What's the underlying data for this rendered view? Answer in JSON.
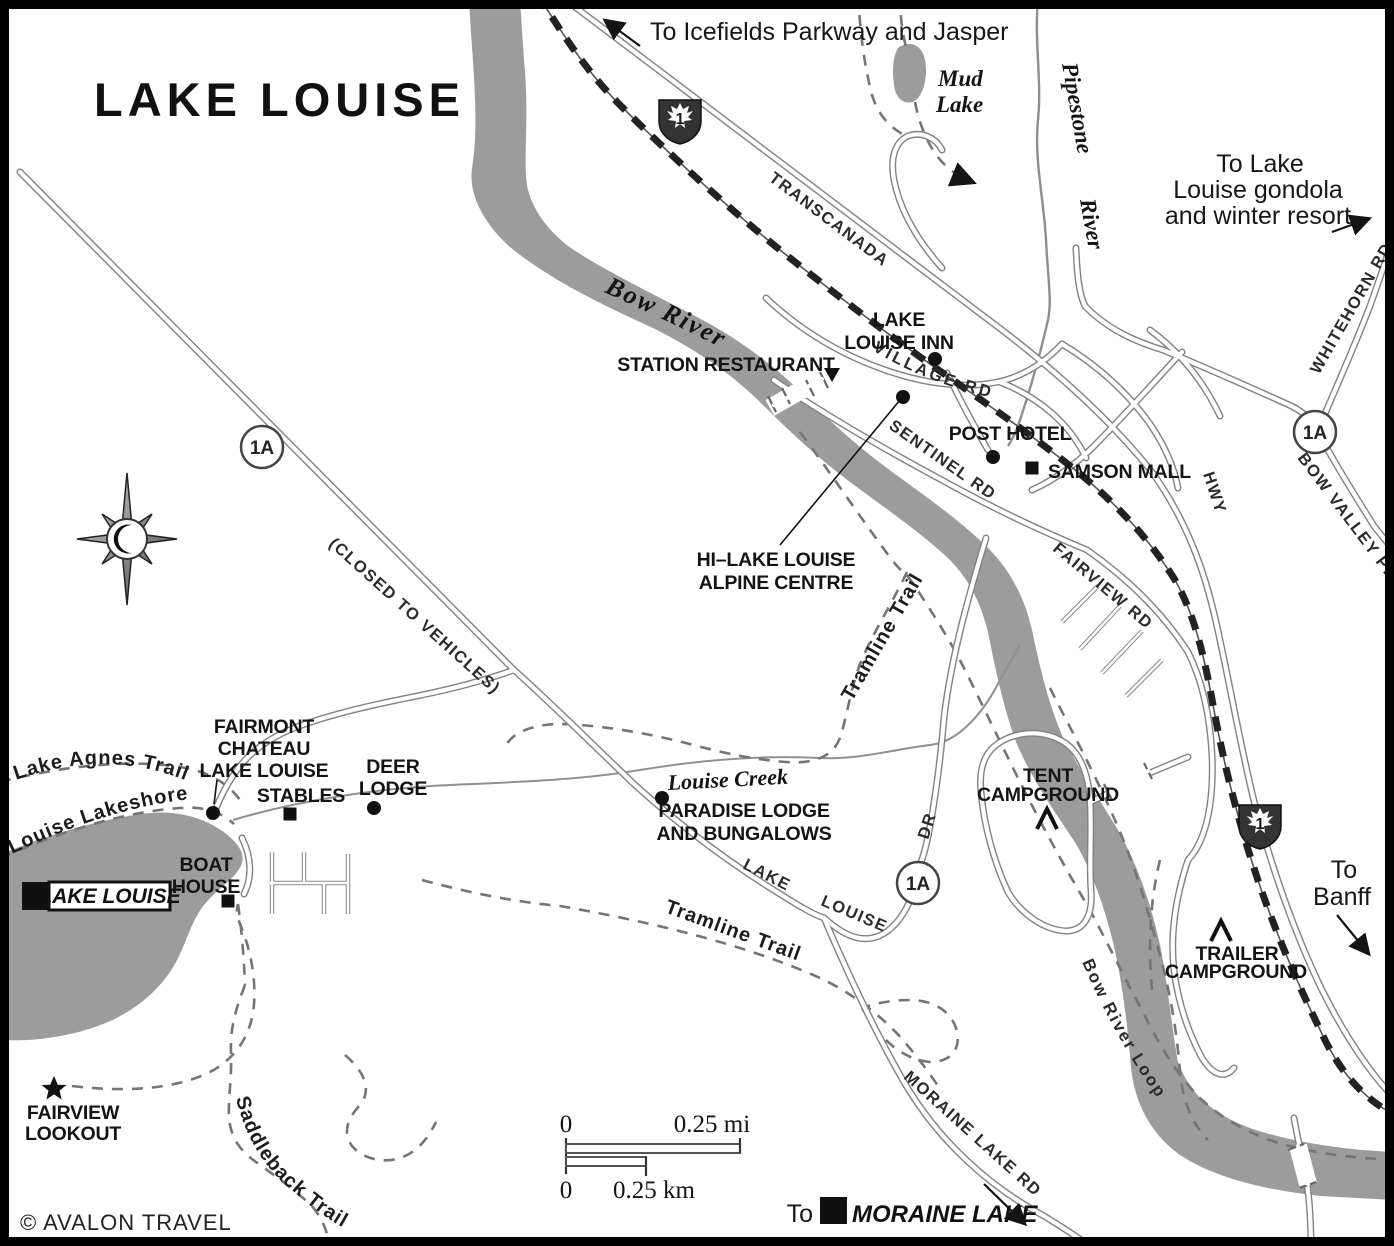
{
  "title": "LAKE LOUISE",
  "copyright": "© AVALON TRAVEL",
  "colors": {
    "water_gray": "#9c9c9c",
    "road_casing": "#828282",
    "trail_gray": "#757575",
    "rail_black": "#222222",
    "text_black": "#141414"
  },
  "directions": {
    "icefields": "To Icefields Parkway and Jasper",
    "gondola_l1": "To Lake",
    "gondola_l2": "Louise gondola",
    "gondola_l3": "and winter resort",
    "banff_l1": "To",
    "banff_l2": "Banff",
    "moraine_prefix": "To",
    "moraine_name": "MORAINE LAKE"
  },
  "water": {
    "bow_river": "Bow River",
    "pipestone_l1": "Pipestone",
    "pipestone_l2": "River",
    "mud_lake_l1": "Mud",
    "mud_lake_l2": "Lake",
    "louise_creek": "Louise Creek",
    "lake_louise_box": "LAKE LOUISE"
  },
  "roads": {
    "transcanada": "TRANSCANADA",
    "village_rd": "VILLAGE RD",
    "sentinel_rd": "SENTINEL RD",
    "fairview_rd": "FAIRVIEW RD",
    "hwy": "HWY",
    "whitehorn_rd": "WHITEHORN RD",
    "bow_valley_pkwy": "BOW VALLEY PKWY",
    "lake_louise_dr_l1": "LAKE",
    "lake_louise_dr_l2": "LOUISE",
    "lake_louise_dr_l3": "DR",
    "moraine_lake_rd": "MORAINE LAKE RD",
    "closed_to_vehicles": "(CLOSED TO VEHICLES)",
    "bow_river_loop": "Bow River Loop"
  },
  "trails": {
    "lake_agnes": "Lake Agnes Trail",
    "louise_lakeshore": "Louise Lakeshore",
    "tramline_upper": "Tramline Trail",
    "tramline_lower": "Tramline Trail",
    "saddleback": "Saddleback Trail"
  },
  "pois": {
    "lake_louise_inn_l1": "LAKE",
    "lake_louise_inn_l2": "LOUISE INN",
    "station_restaurant": "STATION RESTAURANT",
    "post_hotel": "POST HOTEL",
    "samson_mall": "SAMSON MALL",
    "hi_lake_l1": "HI–LAKE LOUISE",
    "hi_lake_l2": "ALPINE CENTRE",
    "fairmont_l1": "FAIRMONT",
    "fairmont_l2": "CHATEAU",
    "fairmont_l3": "LAKE LOUISE",
    "stables": "STABLES",
    "deer_lodge_l1": "DEER",
    "deer_lodge_l2": "LODGE",
    "boat_house_l1": "BOAT",
    "boat_house_l2": "HOUSE",
    "paradise_l1": "PARADISE LODGE",
    "paradise_l2": "AND BUNGALOWS",
    "tent_l1": "TENT",
    "tent_l2": "CAMPGROUND",
    "trailer_l1": "TRAILER",
    "trailer_l2": "CAMPGROUND",
    "lookout_l1": "FAIRVIEW",
    "lookout_l2": "LOOKOUT"
  },
  "shields": {
    "hwy1": "1",
    "hwy1a": "1A"
  },
  "scale": {
    "zero_mi": "0",
    "mi_label": "0.25 mi",
    "zero_km": "0",
    "km_label": "0.25 km"
  }
}
